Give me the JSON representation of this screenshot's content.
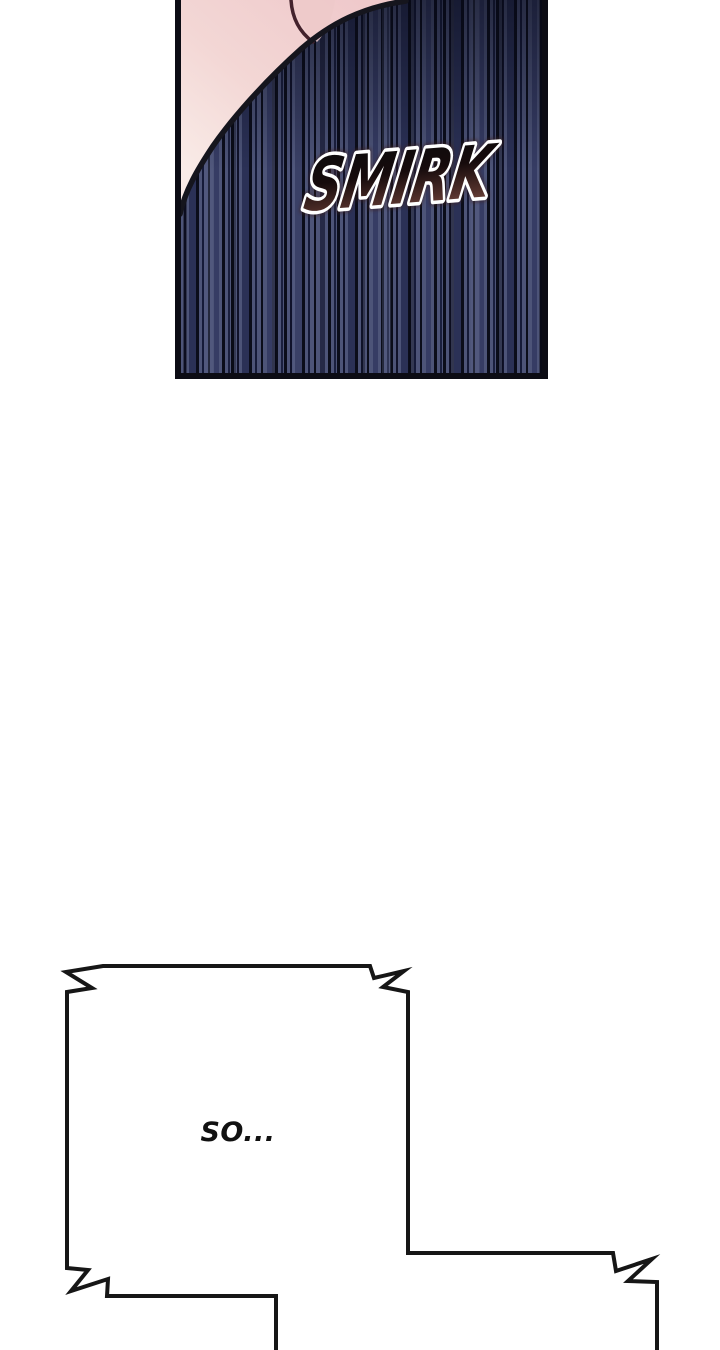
{
  "page": {
    "type_label": "comic-page",
    "background_color": "#ffffff"
  },
  "panel": {
    "sfx_text": "SMIRK",
    "colors": {
      "stripe_base": "#4d5478",
      "stripe_black": "#0b0d1a",
      "stripe_mid": "#2b3156",
      "skin_pink": "#efc9cb",
      "skin_light": "#f9ebe7",
      "line_dark": "#15151d",
      "sfx_fill_top": "#0b0b0d",
      "sfx_fill_bottom": "#7d5045",
      "sfx_outline": "#ffffff"
    }
  },
  "speech_bubble": {
    "text": "SO...",
    "text_color": "#111111",
    "outline_color": "#161616",
    "fill_color": "#ffffff"
  }
}
